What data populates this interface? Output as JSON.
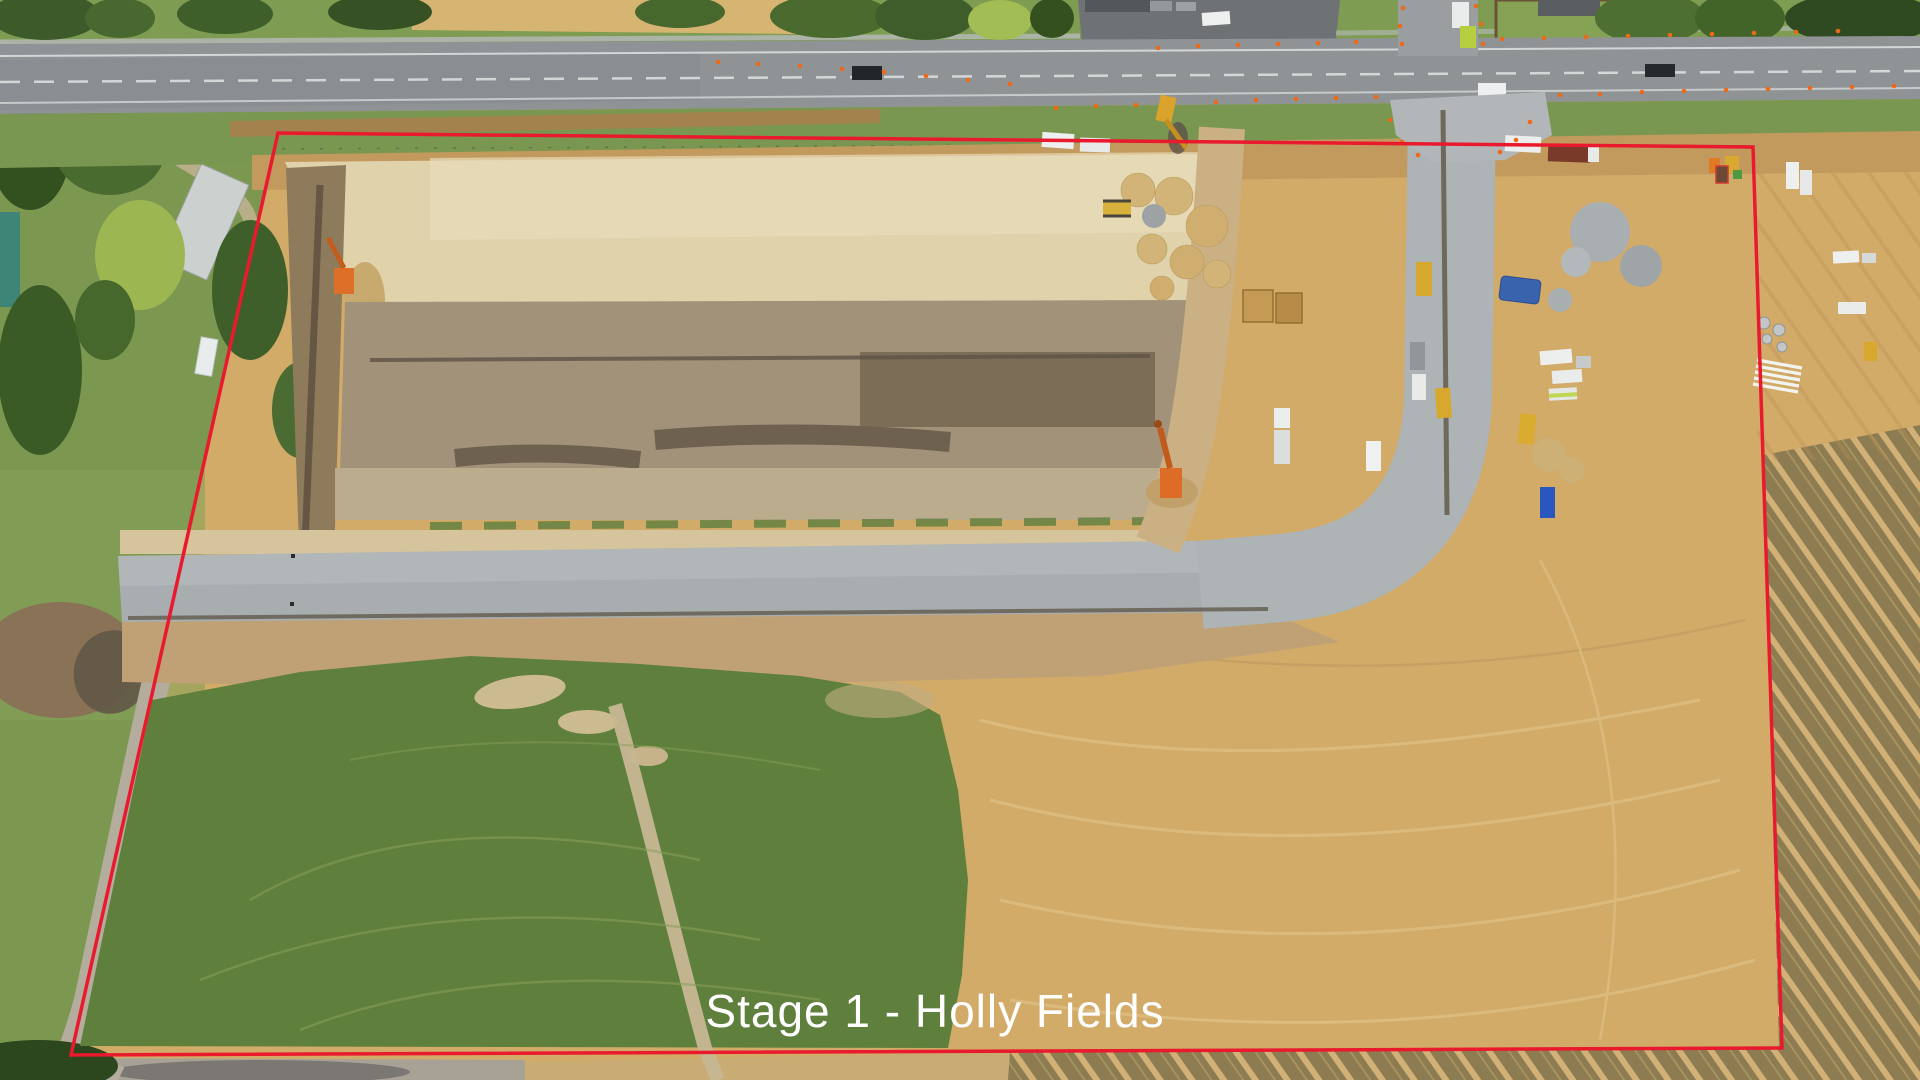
{
  "annotation": {
    "label": "Stage 1 - Holly Fields",
    "label_color": "#ffffff",
    "boundary_color": "#e9192e"
  },
  "scene": {
    "type": "aerial-drone-photo",
    "features": [
      "rural-highway",
      "construction-entrance",
      "new-gravel-road",
      "pipeline-trench",
      "earthworks-pads",
      "topsoil-windrows",
      "green-paddock",
      "stubble-field",
      "staging-area",
      "construction-vehicles",
      "traffic-cones",
      "farm-buildings"
    ],
    "colors": {
      "asphalt": "#8f9396",
      "verge_grass": "#7a9751",
      "pale_earthworks": "#e0d2ab",
      "topsoil_brown": "#7c6d57",
      "gravel_road": "#a8adb0",
      "dirt_tan": "#d2ab69",
      "stubble_olive": "#8d7c51",
      "paddock_green": "#5f7f3c",
      "cone_orange": "#ec6a17"
    }
  }
}
